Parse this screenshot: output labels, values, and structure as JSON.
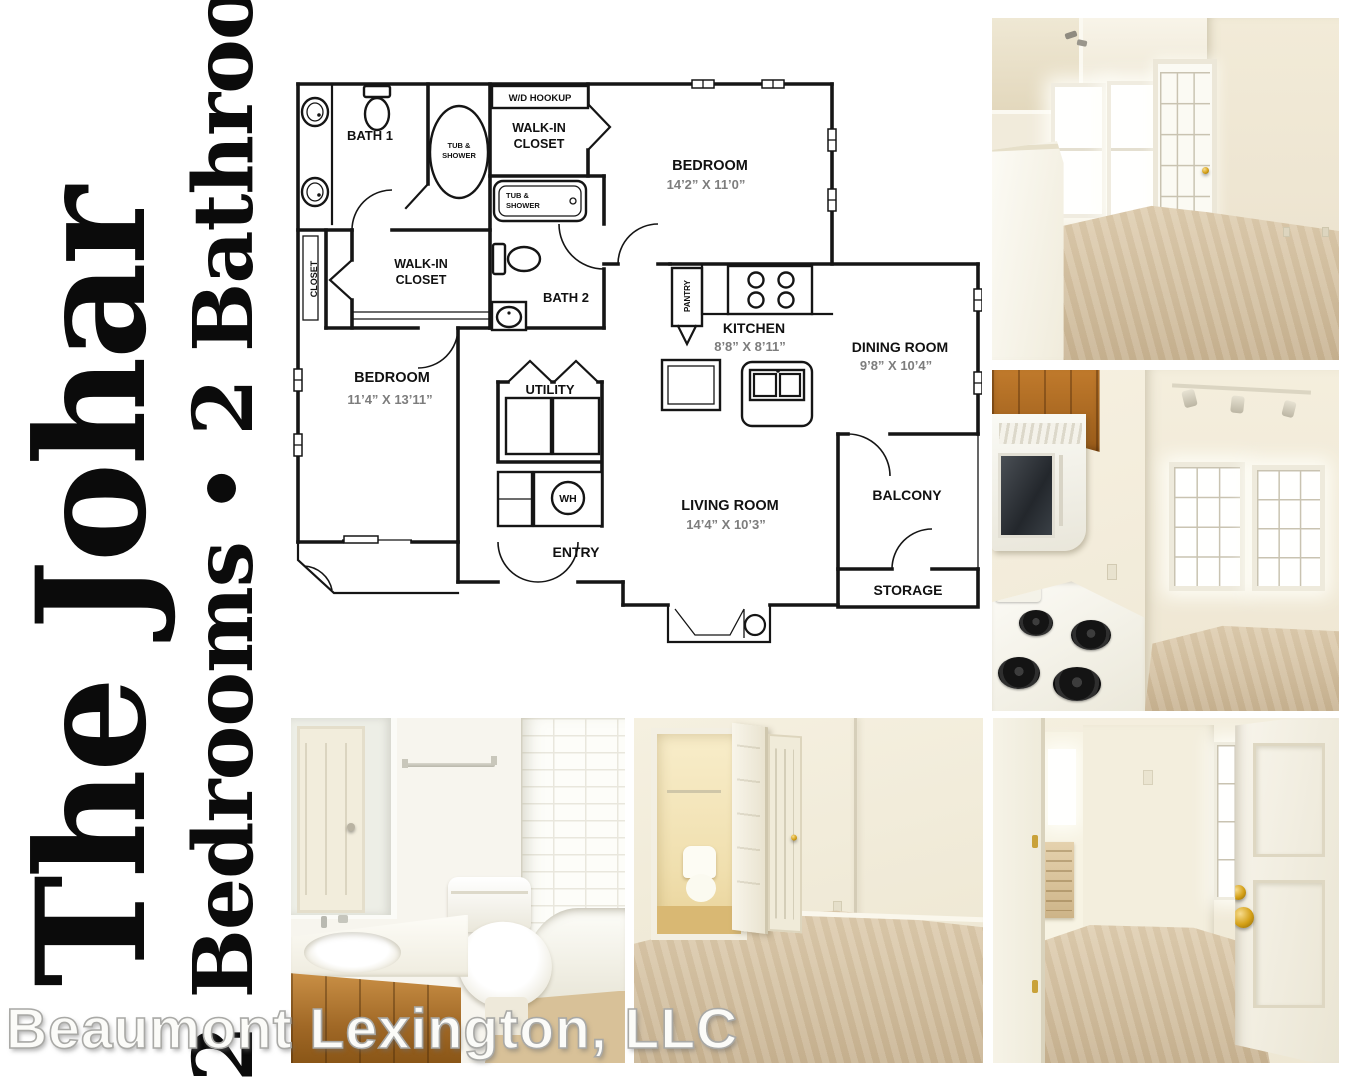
{
  "titles": {
    "name": "The Johar",
    "subtitle": "2 Bedrooms • 2 Bathrooms"
  },
  "footer": {
    "company": "Beaumont Lexington, LLC"
  },
  "floor_plan": {
    "labels": {
      "bath1": "BATH 1",
      "bath2": "BATH 2",
      "wd_hookup": "W/D HOOKUP",
      "walk_in_1": "WALK-IN",
      "walk_in_2": "CLOSET",
      "tub_1": "TUB &",
      "tub_2": "SHOWER",
      "closet": "CLOSET",
      "pantry": "PANTRY",
      "bedroom": "BEDROOM",
      "bedroom1_dims": "14’2” X 11’0”",
      "bedroom2_dims": "11’4” X 13’11”",
      "kitchen": "KITCHEN",
      "kitchen_dims": "8’8” X 8’11”",
      "dining": "DINING ROOM",
      "dining_dims": "9’8” X 10’4”",
      "living": "LIVING ROOM",
      "living_dims": "14’4” X 10’3”",
      "utility": "UTILITY",
      "wh": "WH",
      "balcony": "BALCONY",
      "entry": "ENTRY",
      "storage": "STORAGE"
    }
  },
  "photos": [
    {
      "name": "living-dining-room"
    },
    {
      "name": "kitchen"
    },
    {
      "name": "bathroom"
    },
    {
      "name": "bedroom-with-closet"
    },
    {
      "name": "entry-hallway"
    }
  ],
  "colors": {
    "carpet": "#d6c3a5",
    "wall_cream": "#f1ebdb",
    "oak_cabinet": "#b5752b",
    "brass": "#c9961e",
    "plan_line": "#151515",
    "dim_text": "#7d7d7d"
  }
}
